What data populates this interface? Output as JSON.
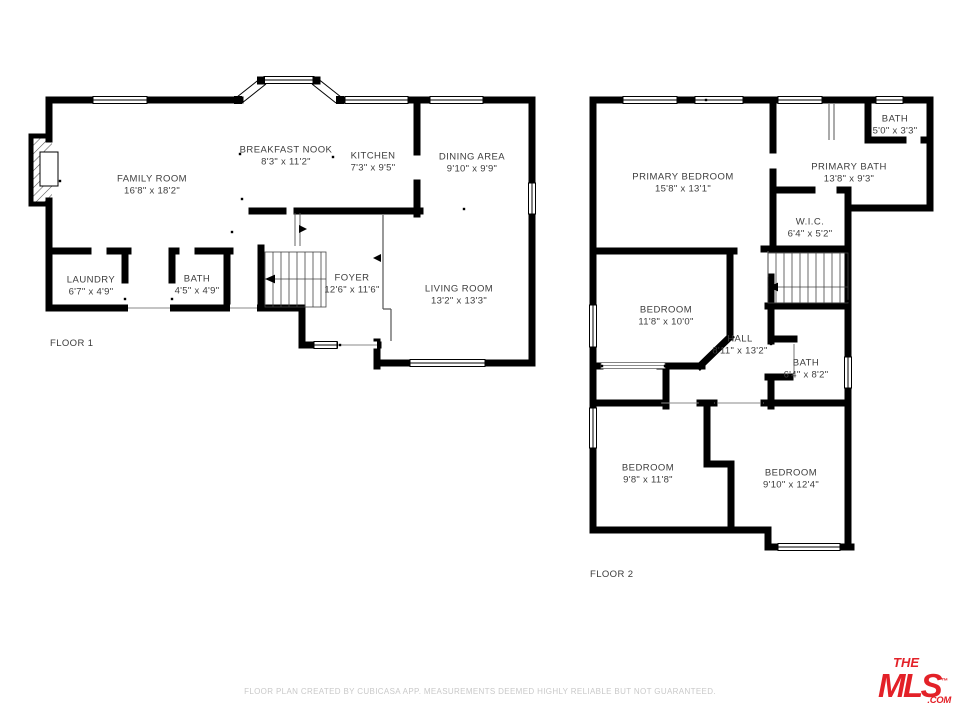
{
  "floor1": {
    "label": "FLOOR 1",
    "rooms": {
      "family_room": {
        "name": "FAMILY ROOM",
        "dims": "16'8\" x 18'2\""
      },
      "breakfast_nook": {
        "name": "BREAKFAST NOOK",
        "dims": "8'3\" x 11'2\""
      },
      "kitchen": {
        "name": "KITCHEN",
        "dims": "7'3\" x 9'5\""
      },
      "dining_area": {
        "name": "DINING AREA",
        "dims": "9'10\" x 9'9\""
      },
      "laundry": {
        "name": "LAUNDRY",
        "dims": "6'7\" x 4'9\""
      },
      "bath": {
        "name": "BATH",
        "dims": "4'5\" x 4'9\""
      },
      "foyer": {
        "name": "FOYER",
        "dims": "12'6\" x 11'6\""
      },
      "living_room": {
        "name": "LIVING ROOM",
        "dims": "13'2\" x 13'3\""
      }
    }
  },
  "floor2": {
    "label": "FLOOR 2",
    "rooms": {
      "primary_bedroom": {
        "name": "PRIMARY BEDROOM",
        "dims": "15'8\" x 13'1\""
      },
      "bath_top": {
        "name": "BATH",
        "dims": "5'0\" x 3'3\""
      },
      "primary_bath": {
        "name": "PRIMARY BATH",
        "dims": "13'8\" x 9'3\""
      },
      "wic": {
        "name": "W.I.C.",
        "dims": "6'4\" x 5'2\""
      },
      "bedroom_mid": {
        "name": "BEDROOM",
        "dims": "11'8\" x 10'0\""
      },
      "hall": {
        "name": "HALL",
        "dims": "8'11\" x 13'2\""
      },
      "bath_mid": {
        "name": "BATH",
        "dims": "6'4\" x 8'2\""
      },
      "bedroom_bl": {
        "name": "BEDROOM",
        "dims": "9'8\" x 11'8\""
      },
      "bedroom_br": {
        "name": "BEDROOM",
        "dims": "9'10\" x 12'4\""
      }
    }
  },
  "footer": {
    "disclaimer": "FLOOR PLAN CREATED BY CUBICASA APP. MEASUREMENTS DEEMED HIGHLY RELIABLE BUT NOT GUARANTEED."
  },
  "logo": {
    "the": "THE",
    "mls": "MLS",
    "tm": "™",
    "com": ".COM"
  },
  "colors": {
    "wall": "#000000",
    "label": "#3d3d3d",
    "footer_text": "#c9c9c9",
    "logo_red": "#e32128"
  }
}
